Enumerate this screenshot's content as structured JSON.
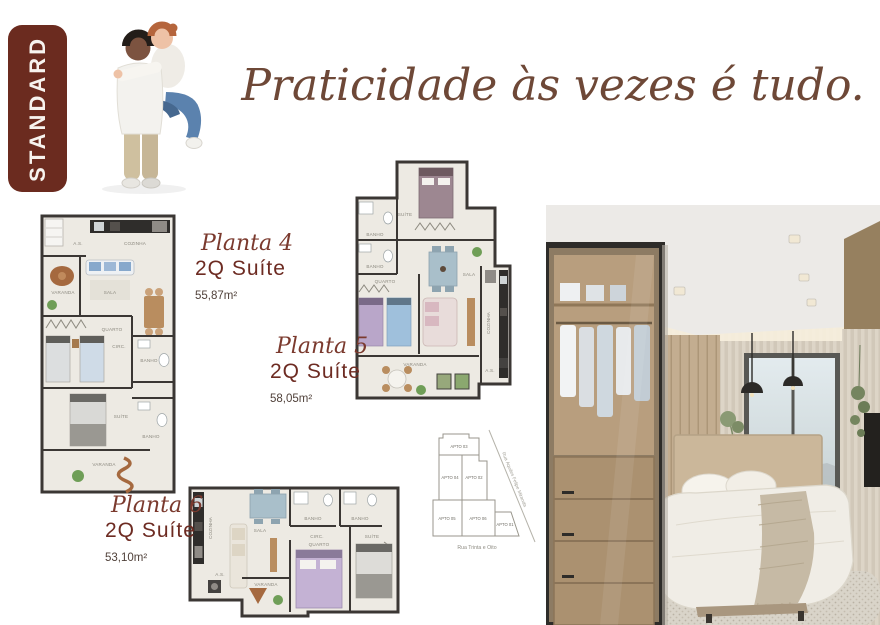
{
  "badge": {
    "label": "STANDARD",
    "bg_color": "#6B2B1F",
    "text_color": "#F7F3EE"
  },
  "headline": {
    "text": "Praticidade às vezes é tudo.",
    "color": "#6E4837"
  },
  "plans": [
    {
      "name": "Planta 4",
      "type": "2Q Suíte",
      "area": "55,87m²",
      "rooms": [
        "A.S.",
        "COZINHA",
        "VARANDA",
        "SALA",
        "QUARTO",
        "CIRC.",
        "BANHO",
        "SUÍTE",
        "BANHO",
        "VARANDA"
      ]
    },
    {
      "name": "Planta 5",
      "type": "2Q Suíte",
      "area": "58,05m²",
      "rooms": [
        "SUÍTE",
        "BANHO",
        "BANHO",
        "QUARTO",
        "SALA",
        "COZINHA",
        "A.S.",
        "VARANDA"
      ]
    },
    {
      "name": "Planta 6",
      "type": "2Q Suíte",
      "area": "53,10m²",
      "rooms": [
        "COZINHA",
        "A.S.",
        "SALA",
        "VARANDA",
        "BANHO",
        "BANHO",
        "CIRC.",
        "QUARTO",
        "SUÍTE"
      ]
    }
  ],
  "site_plan": {
    "units": [
      {
        "label": "APTO 03",
        "highlighted": false
      },
      {
        "label": "APTO 04",
        "highlighted": true
      },
      {
        "label": "APTO 02",
        "highlighted": false
      },
      {
        "label": "APTO 05",
        "highlighted": true
      },
      {
        "label": "APTO 06",
        "highlighted": true
      },
      {
        "label": "APTO 01",
        "highlighted": false
      }
    ],
    "street_diagonal": "Rua Aquiles Felipe Miranda",
    "street_bottom": "Rua Trinta e Oito",
    "highlight_color": "#D8D7CF"
  }
}
